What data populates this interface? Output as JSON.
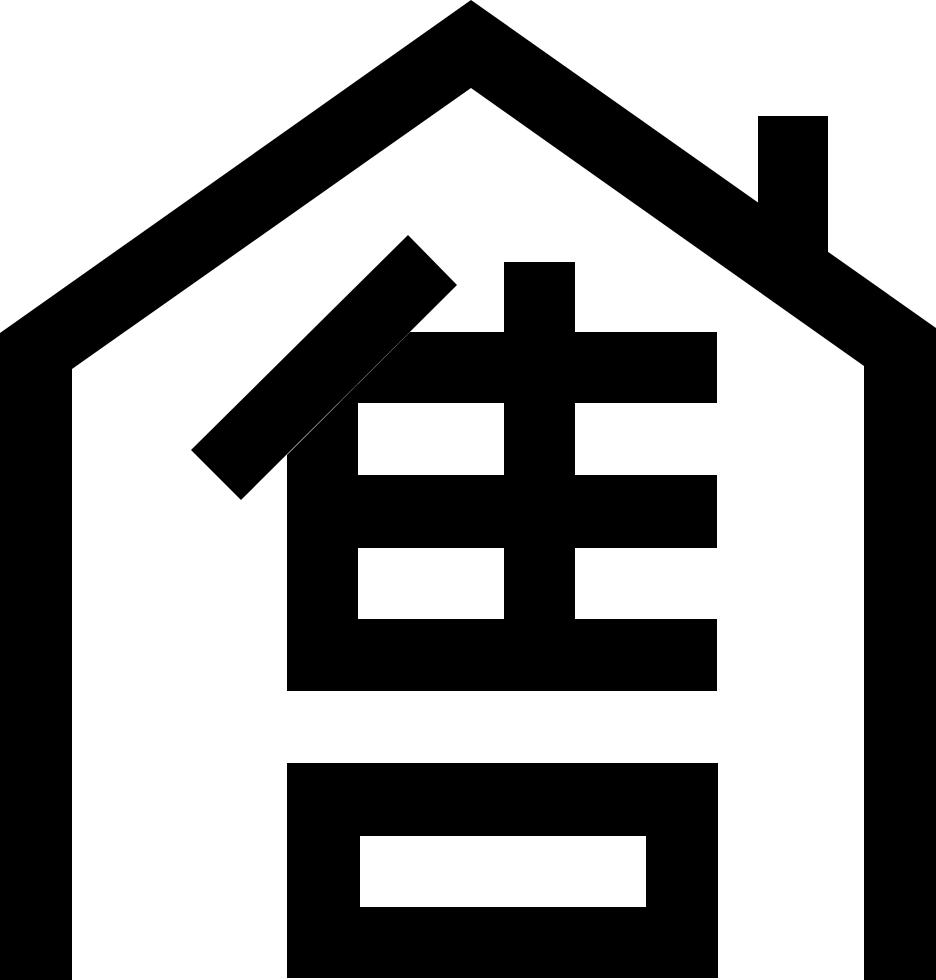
{
  "icon": {
    "name": "house-for-sale-icon",
    "description": "Black glyph of a house outline with gable roof and chimney, containing the Chinese character for sell",
    "character": "售",
    "character_meaning": "sell",
    "colors": {
      "foreground": "#000000",
      "background": "#ffffff"
    },
    "canvas": {
      "width": 936,
      "height": 980
    },
    "shapes": [
      {
        "name": "house-outline",
        "fill": "foreground",
        "points": "471,0 936,328 936,980 864,980 864,366 471,88 72,369 72,980 0,980 0,333"
      },
      {
        "name": "chimney",
        "fill": "foreground",
        "points": "758,116 828,116 828,290 758,290"
      },
      {
        "name": "char-left-diagonal-stroke",
        "fill": "foreground",
        "points": "408,235 457,285 241,500 191,450"
      },
      {
        "name": "char-horizontal-stroke-1",
        "fill": "foreground",
        "points": "410,332 717,332 717,403 339,403"
      },
      {
        "name": "char-left-vertical-stroke",
        "fill": "foreground",
        "points": "287,455 358,384 358,691 287,691"
      },
      {
        "name": "char-center-vertical-stroke",
        "fill": "foreground",
        "points": "504,262 575,262 575,691 504,691"
      },
      {
        "name": "char-horizontal-stroke-2",
        "fill": "foreground",
        "points": "358,475 717,475 717,548 358,548"
      },
      {
        "name": "char-horizontal-stroke-3",
        "fill": "foreground",
        "points": "358,619 717,619 717,691 358,691"
      },
      {
        "name": "char-mouth-box",
        "fill": "foreground",
        "points": "287,763 718,763 718,978 287,978"
      },
      {
        "name": "char-mouth-box-hole",
        "fill": "background",
        "points": "360,836 646,836 646,907 360,907"
      }
    ]
  }
}
